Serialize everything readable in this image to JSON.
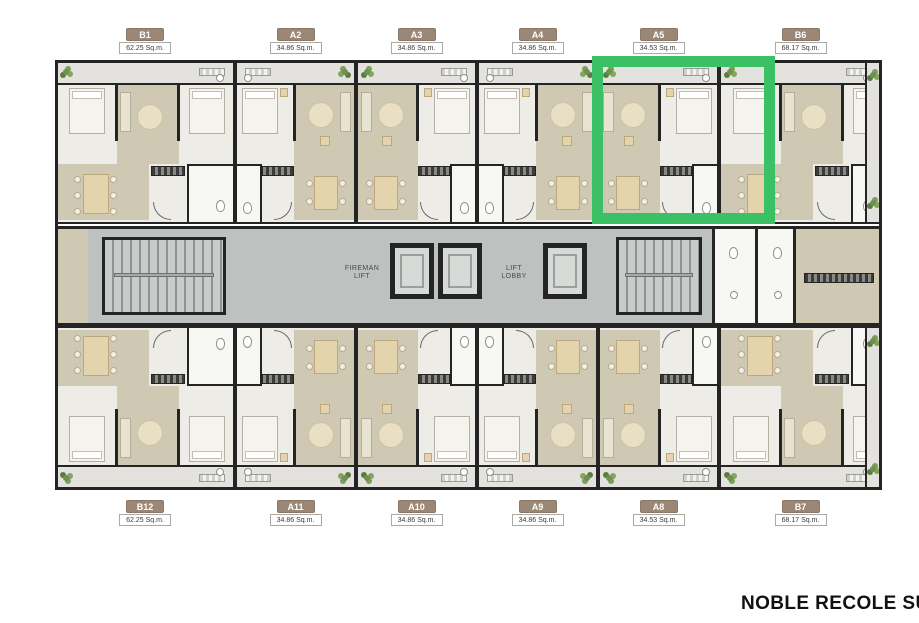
{
  "brand": "NOBLE RECOLE SU",
  "highlight_unit": "A5",
  "colors": {
    "highlight_green": "#3cc065",
    "badge_brown": "#9b8775",
    "wall_dark": "#242424",
    "floor_tan": "#cfc9b3",
    "floor_light": "#edece7",
    "core_gray": "#bdc1bf"
  },
  "core": {
    "fireman_lift": "FIREMAN\nLIFT",
    "lift_lobby": "LIFT\nLOBBY"
  },
  "units": {
    "top": [
      {
        "id": "B1",
        "area": "62.25 Sq.m."
      },
      {
        "id": "A2",
        "area": "34.86 Sq.m."
      },
      {
        "id": "A3",
        "area": "34.86 Sq.m."
      },
      {
        "id": "A4",
        "area": "34.86 Sq.m."
      },
      {
        "id": "A5",
        "area": "34.53 Sq.m.",
        "highlighted": true
      },
      {
        "id": "B6",
        "area": "68.17 Sq.m."
      }
    ],
    "bottom": [
      {
        "id": "B12",
        "area": "62.25 Sq.m."
      },
      {
        "id": "A11",
        "area": "34.86 Sq.m."
      },
      {
        "id": "A10",
        "area": "34.86 Sq.m."
      },
      {
        "id": "A9",
        "area": "34.86 Sq.m."
      },
      {
        "id": "A8",
        "area": "34.53 Sq.m."
      },
      {
        "id": "B7",
        "area": "68.17 Sq.m."
      }
    ]
  }
}
